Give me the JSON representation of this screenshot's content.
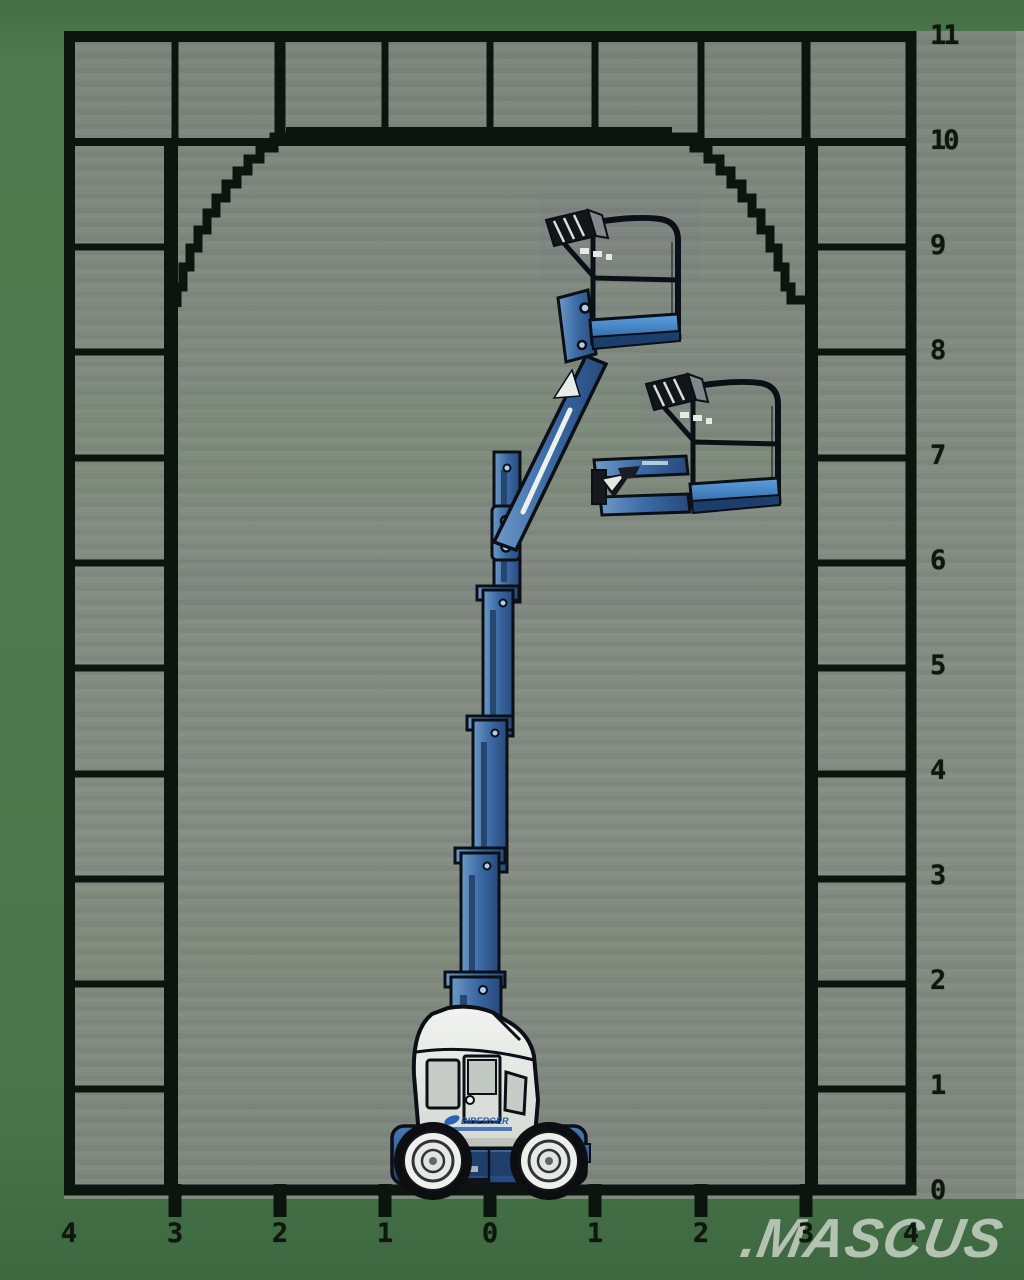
{
  "axes": {
    "y_labels": [
      "11",
      "10",
      "9",
      "8",
      "7",
      "6",
      "5",
      "4",
      "3",
      "2",
      "1",
      "0"
    ],
    "x_labels": [
      "4",
      "3",
      "2",
      "1",
      "0",
      "1",
      "2",
      "3",
      "4"
    ]
  },
  "machine": {
    "logo_text": "BIBERGER",
    "description": "Self-propelled vertical mast boom lift with articulating jib, shown in two platform positions"
  },
  "watermark": {
    "text": ".MASCUS"
  },
  "palette": {
    "background_green": "#4d784d",
    "plot_grey": "#828b81",
    "line_black": "#0c150d",
    "boom_blue": "#3b6aa4",
    "platform_floor_blue": "#4a8cc8",
    "body_white": "#ebece8",
    "watermark_grey": "#ced6cb"
  },
  "chart_data": {
    "type": "area",
    "title": "Boom lift working envelope",
    "xlabel": "",
    "ylabel": "",
    "x_axis_labels": [
      "4",
      "3",
      "2",
      "1",
      "0",
      "1",
      "2",
      "3",
      "4"
    ],
    "y_axis_labels": [
      "11",
      "10",
      "9",
      "8",
      "7",
      "6",
      "5",
      "4",
      "3",
      "2",
      "1",
      "0"
    ],
    "x_range": [
      -4,
      4
    ],
    "y_range": [
      0,
      11
    ],
    "grid": true,
    "grid_cell_size": 1,
    "envelope_outline_xy": [
      [
        -3,
        0
      ],
      [
        -3,
        8.5
      ],
      [
        -2.6,
        9.4
      ],
      [
        -2,
        10.1
      ],
      [
        1.75,
        10.1
      ],
      [
        2.3,
        9.5
      ],
      [
        3,
        8.5
      ],
      [
        3,
        0
      ]
    ],
    "platform_positions_xy": [
      [
        1.2,
        8.2
      ],
      [
        2.1,
        6.7
      ]
    ],
    "machine_center_x": 0
  }
}
